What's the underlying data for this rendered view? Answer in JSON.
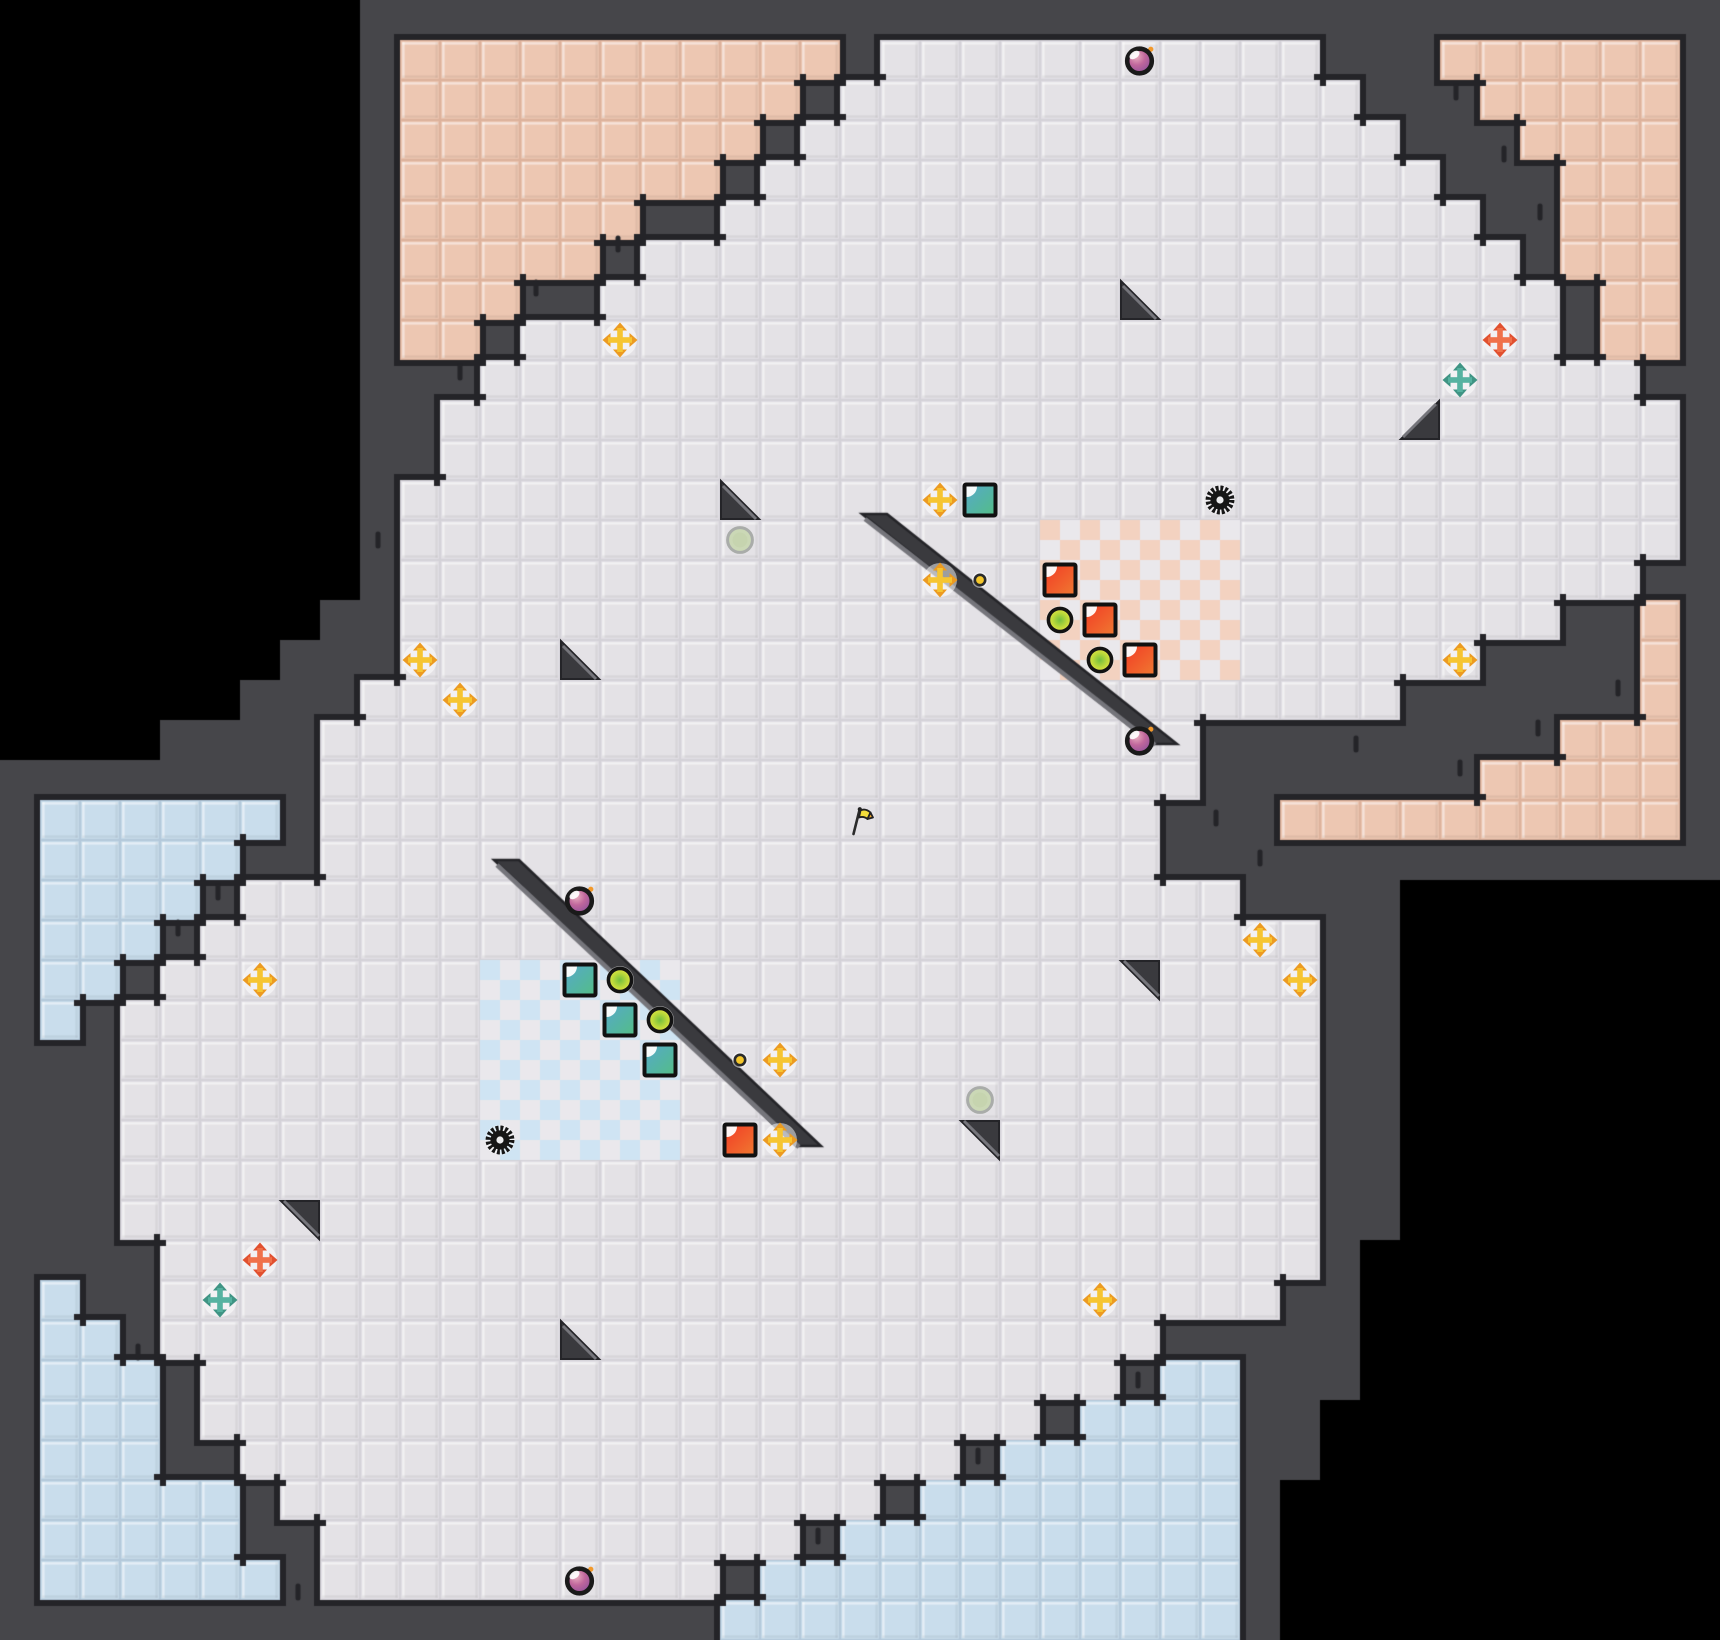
{
  "map": {
    "cols": 43,
    "rows": 41,
    "tile": 40,
    "legend": {
      "#": "wall",
      ".": "floor",
      "s": "salmon",
      "b": "blue",
      " ": "void"
    },
    "tiles": [
      "         ##################################",
      "         #sssssssssss#...........###ssssss#",
      "         #ssssssssss#.............###sssss#",
      "         #sssssssss#...............###ssss#",
      "         #ssssssss#.................###sss#",
      "         #ssssss##...................##sss#",
      "         #sssss#......................#sss#",
      "         #sss##........................#ss#",
      "         #ss#..........................#ss#",
      "         ###.............................##",
      "         ##...............................#",
      "         ##...............................#",
      "         #................................#",
      "         #................................#",
      "         #...............................##",
      "        ##.............................##s#",
      "       ###...........................####s#",
      "      ###..........................######s#",
      "    ####......................#########sss#",
      "########......................#######sssss#",
      "#bbbbbb#.....................###ssssssssss#",
      "#bbbbb##.....................##############",
      "#bbbb#.........................####        ",
      "#bbb#............................##        ",
      "#bb#.............................##        ",
      "#b#..............................##        ",
      "###..............................##        ",
      "###..............................##        ",
      "###..............................##        ",
      "###..............................##        ",
      "###..............................##        ",
      "####.............................#         ",
      "#b##............................##         ",
      "#bb#.........................#####         ",
      "#bbb#.......................#bb###         ",
      "#bbb#.....................#bbbb##          ",
      "#bbb##..................#bbbbbb##          ",
      "#bbbbb#...............#bbbbbbbb#           ",
      "#bbbbb##............#bbbbbbbbbb#           ",
      "#bbbbbb#..........#bbbbbbbbbbbb#           ",
      "##################bbbbbbbbbbbbb#           "
    ]
  },
  "colors": {
    "void": "#000000",
    "wall": "#46464A",
    "wall_dark": "#242428",
    "wall_light": "#75757B",
    "floor": "#E4E2E6",
    "floor_gap": "#D4D2D8",
    "salmon": "#EDC7B2",
    "salmon_gap": "#DDB29C",
    "blue": "#C9DDEC",
    "blue_gap": "#B4C9DB",
    "checker_salmon": "#F3D2C0",
    "checker_blue": "#CFE4F3",
    "checker_light": "#EAE8EC",
    "bevel_light": "rgba(255,255,255,0.5)",
    "bevel_dark": "rgba(0,0,0,0.05)",
    "cross_yellow": "#F6C531",
    "cross_yellow_tip": "#EC9B22",
    "cross_orange": "#F0714A",
    "cross_orange_tip": "#E1502F",
    "cross_teal": "#55B2A0",
    "cross_teal_tip": "#3F9484",
    "paper_red_a": "#F23A25",
    "paper_red_b": "#F07A31",
    "paper_teal_a": "#56A8CC",
    "paper_teal_b": "#53BE85",
    "coin_center": "#72BE3F",
    "coin_mid": "#BBD93A",
    "coin_edge": "#EDE446",
    "bomb_hi": "#E9B0C0",
    "bomb_mid": "#C0679C",
    "bomb_low": "#8A4E9B",
    "bomb_spark": "#F2992B",
    "orb_pale": "#CBD8B6",
    "orb_ring": "#A9ACA9",
    "dot_yellow": "#F5C72B",
    "flag_yellow": "#F2DC3B",
    "flag_orange": "#F0A82E",
    "gear": "#161616",
    "spike": "#3A3A3E"
  },
  "checker_regions": [
    {
      "kind": "salmon",
      "col": 26,
      "row": 13,
      "cols": 5,
      "rows": 4
    },
    {
      "kind": "blue",
      "col": 12,
      "row": 24,
      "cols": 5,
      "rows": 5
    }
  ],
  "slashes": [
    {
      "x1": 21.55,
      "y1": 12.85,
      "x2": 28.8,
      "y2": 18.6
    },
    {
      "x1": 12.35,
      "y1": 21.5,
      "x2": 19.9,
      "y2": 28.65
    }
  ],
  "wall_ticks": [
    [
      15.45,
      6.1
    ],
    [
      13.4,
      7.2
    ],
    [
      11.5,
      9.3
    ],
    [
      36.4,
      2.3
    ],
    [
      37.6,
      3.85
    ],
    [
      38.5,
      5.3
    ],
    [
      40.45,
      17.2
    ],
    [
      38.45,
      18.2
    ],
    [
      36.5,
      19.2
    ],
    [
      33.9,
      18.6
    ],
    [
      30.4,
      20.45
    ],
    [
      31.5,
      21.45
    ],
    [
      5.45,
      22.3
    ],
    [
      4.45,
      23.2
    ],
    [
      3.45,
      33.8
    ],
    [
      28.45,
      34.5
    ],
    [
      24.45,
      36.4
    ],
    [
      20.45,
      38.4
    ],
    [
      7.45,
      39.8
    ],
    [
      9.45,
      13.5
    ]
  ],
  "entities": [
    [
      "bomb",
      28,
      1
    ],
    [
      "bomb",
      28,
      18
    ],
    [
      "bomb",
      14,
      22
    ],
    [
      "bomb",
      14,
      39
    ],
    [
      "gear",
      30,
      12
    ],
    [
      "gear",
      12,
      28
    ],
    [
      "flag",
      21,
      20
    ],
    [
      "orb",
      18,
      13
    ],
    [
      "orb",
      24,
      27
    ],
    [
      "dot",
      24,
      14
    ],
    [
      "dot",
      18,
      26
    ],
    [
      "coin",
      26,
      15
    ],
    [
      "coin",
      27,
      16
    ],
    [
      "coin",
      15,
      24
    ],
    [
      "coin",
      16,
      25
    ],
    [
      "paper_red",
      26,
      14
    ],
    [
      "paper_red",
      27,
      15
    ],
    [
      "paper_red",
      28,
      16
    ],
    [
      "paper_red",
      18,
      28
    ],
    [
      "paper_teal",
      24,
      12
    ],
    [
      "paper_teal",
      14,
      24
    ],
    [
      "paper_teal",
      15,
      25
    ],
    [
      "paper_teal",
      16,
      26
    ],
    [
      "cross_yellow",
      15,
      8
    ],
    [
      "cross_yellow",
      23,
      12
    ],
    [
      "cross_yellow",
      23,
      14
    ],
    [
      "cross_yellow",
      10,
      16
    ],
    [
      "cross_yellow",
      11,
      17
    ],
    [
      "cross_yellow",
      36,
      16
    ],
    [
      "cross_yellow",
      31,
      23
    ],
    [
      "cross_yellow",
      32,
      24
    ],
    [
      "cross_yellow",
      6,
      24
    ],
    [
      "cross_yellow",
      19,
      26
    ],
    [
      "cross_yellow",
      19,
      28
    ],
    [
      "cross_yellow",
      27,
      32
    ],
    [
      "cross_orange",
      37,
      8
    ],
    [
      "cross_orange",
      6,
      31
    ],
    [
      "cross_teal",
      36,
      9
    ],
    [
      "cross_teal",
      5,
      32
    ],
    [
      "spike_sw",
      28,
      7
    ],
    [
      "spike_se",
      35,
      10
    ],
    [
      "spike_sw",
      18,
      12
    ],
    [
      "spike_sw",
      14,
      16
    ],
    [
      "spike_ne",
      28,
      24
    ],
    [
      "spike_ne",
      24,
      28
    ],
    [
      "spike_ne",
      7,
      30
    ],
    [
      "spike_sw",
      14,
      33
    ]
  ]
}
